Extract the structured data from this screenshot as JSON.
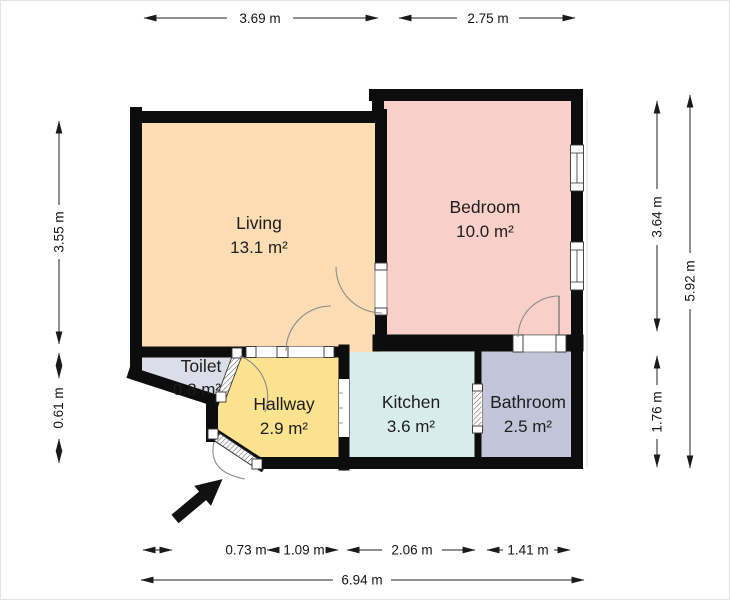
{
  "rooms": [
    {
      "name": "Living",
      "area": "13.1 m²",
      "color": "#fbdcb3"
    },
    {
      "name": "Bedroom",
      "area": "10.0 m²",
      "color": "#f8cfc9"
    },
    {
      "name": "Toilet",
      "area": "0.8 m²",
      "color": "#dcdde8"
    },
    {
      "name": "Hallway",
      "area": "2.9 m²",
      "color": "#fae28e"
    },
    {
      "name": "Kitchen",
      "area": "3.6 m²",
      "color": "#d8eceb"
    },
    {
      "name": "Bathroom",
      "area": "2.5 m²",
      "color": "#c2c5d9"
    }
  ],
  "dims": {
    "top": [
      "3.69 m",
      "2.75 m"
    ],
    "left": [
      "3.55 m",
      "0.61 m"
    ],
    "right": [
      "3.64 m",
      "1.76 m",
      "5.92 m"
    ],
    "bottom": [
      "0.73 m",
      "1.09 m",
      "2.06 m",
      "1.41 m"
    ],
    "total": "6.94 m"
  },
  "colors": {
    "wall": "#0d0d0d",
    "dimension": "#1a1a1a"
  }
}
